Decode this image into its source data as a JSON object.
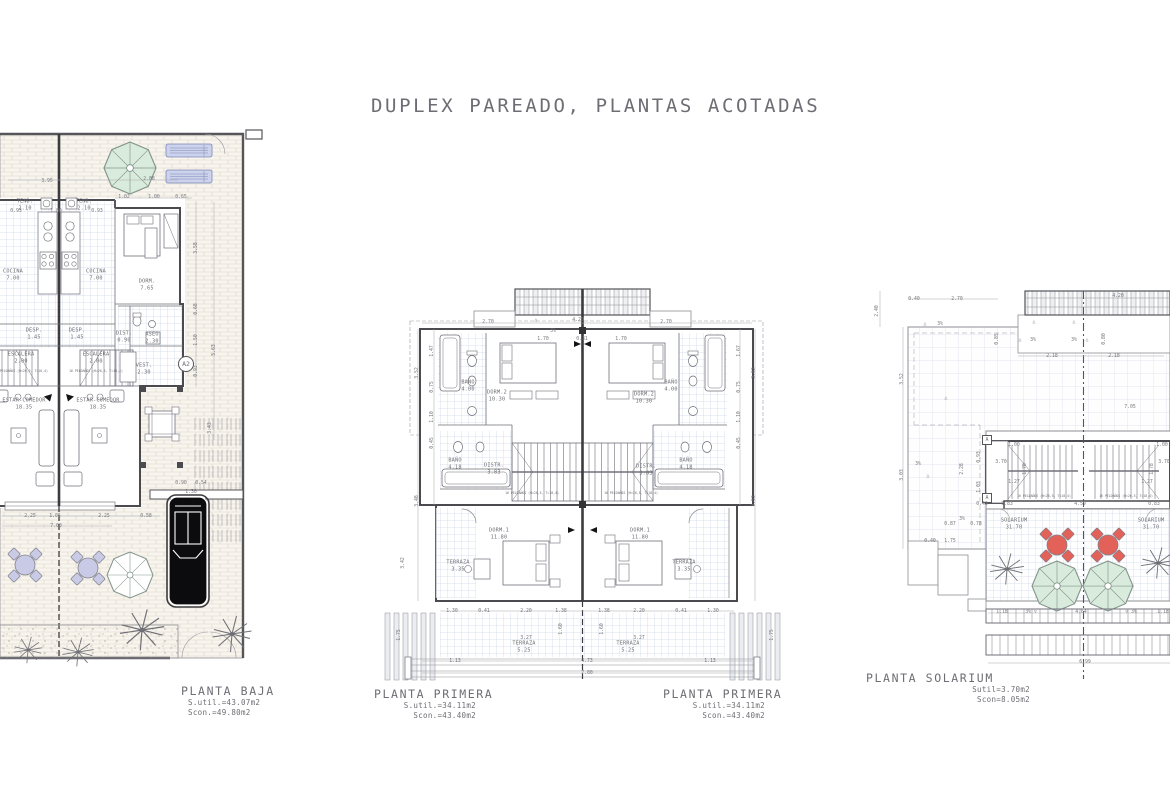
{
  "title": "DUPLEX PAREADO, PLANTAS ACOTADAS",
  "colors": {
    "line": "#8f8f95",
    "wall": "#4a4a4f",
    "text": "#6d6d74",
    "tile": "#bcc3e0",
    "paving": "#ddd5c6",
    "green": "#d8ebdc",
    "blue": "#cdd3ec",
    "purple": "#c9cbe6",
    "red": "#e2625a",
    "car": "#0c0c0e"
  },
  "captions": {
    "baja": {
      "name": "PLANTA BAJA",
      "line1": "S.util.=43.07m2",
      "line2": "Scon.=49.80m2"
    },
    "primera_left": {
      "name": "PLANTA PRIMERA",
      "line1": "S.util.=34.11m2",
      "line2": "Scon.=43.40m2"
    },
    "primera_right": {
      "name": "PLANTA PRIMERA",
      "line1": "S.util.=34.11m2",
      "line2": "Scon.=43.40m2"
    },
    "solarium": {
      "name": "PLANTA SOLARIUM",
      "line1": "Sutil=3.70m2",
      "line2": "Scon=8.05m2"
    }
  },
  "labels": {
    "baja": [
      {
        "t": "TEND.\n2.10",
        "x": 25,
        "y": 77
      },
      {
        "t": "TEND.\n2.10",
        "x": 84,
        "y": 77
      },
      {
        "t": "COCINA\n7.00",
        "x": 13,
        "y": 147
      },
      {
        "t": "COCINA\n7.00",
        "x": 96,
        "y": 147
      },
      {
        "t": "DORM.\n7.65",
        "x": 147,
        "y": 157
      },
      {
        "t": "DESP.\n1.45",
        "x": 34,
        "y": 206
      },
      {
        "t": "DESP.\n1.45",
        "x": 77,
        "y": 206
      },
      {
        "t": "DIST.\n0.90",
        "x": 124,
        "y": 209
      },
      {
        "t": "ASEO\n2.30",
        "x": 152,
        "y": 210
      },
      {
        "t": "ESCALERA\n2.00",
        "x": 21,
        "y": 230
      },
      {
        "t": "ESCALERA\n2.00",
        "x": 96,
        "y": 230
      },
      {
        "t": "16 PELDAÑOS (H=26,5, T=18,4)",
        "x": 21,
        "y": 243,
        "c": "tiny"
      },
      {
        "t": "16 PELDAÑOS (H=26,5, T=18,4)",
        "x": 96,
        "y": 243,
        "c": "tiny"
      },
      {
        "t": "VEST.\n2.30",
        "x": 144,
        "y": 241
      },
      {
        "t": "A2",
        "x": 186,
        "y": 236,
        "c": "marker"
      },
      {
        "t": "ESTAR-COMEDOR\n18.35",
        "x": 24,
        "y": 276
      },
      {
        "t": "ESTAR-COMEDOR\n18.35",
        "x": 98,
        "y": 276
      },
      {
        "t": "3.95",
        "x": 47,
        "y": 54,
        "c": "dim"
      },
      {
        "t": "2.88",
        "x": 149,
        "y": 52,
        "c": "dim"
      },
      {
        "t": "1.02",
        "x": 124,
        "y": 70,
        "c": "dim"
      },
      {
        "t": "1.00",
        "x": 154,
        "y": 70,
        "c": "dim"
      },
      {
        "t": "0.65",
        "x": 181,
        "y": 70,
        "c": "dim"
      },
      {
        "t": "0.93",
        "x": 16,
        "y": 84,
        "c": "dim"
      },
      {
        "t": "1.80",
        "x": 56,
        "y": 84,
        "c": "dim"
      },
      {
        "t": "0.93",
        "x": 97,
        "y": 84,
        "c": "dim"
      },
      {
        "t": "3.58",
        "x": 197,
        "y": 120,
        "c": "dim",
        "r": 90
      },
      {
        "t": "0.68",
        "x": 197,
        "y": 181,
        "c": "dim",
        "r": 90
      },
      {
        "t": "1.50",
        "x": 197,
        "y": 212,
        "c": "dim",
        "r": 90
      },
      {
        "t": "5.63",
        "x": 215,
        "y": 222,
        "c": "dim",
        "r": 90
      },
      {
        "t": "0.93",
        "x": 197,
        "y": 243,
        "c": "dim",
        "r": 90
      },
      {
        "t": "3.43",
        "x": 211,
        "y": 300,
        "c": "dim",
        "r": 90
      },
      {
        "t": "0.90",
        "x": 181,
        "y": 356,
        "c": "dim"
      },
      {
        "t": "0.54",
        "x": 201,
        "y": 356,
        "c": "dim"
      },
      {
        "t": "1.30",
        "x": 191,
        "y": 365,
        "c": "dim"
      },
      {
        "t": "2.25",
        "x": 30,
        "y": 389,
        "c": "dim"
      },
      {
        "t": "1.05",
        "x": 55,
        "y": 389,
        "c": "dim"
      },
      {
        "t": "2.25",
        "x": 104,
        "y": 389,
        "c": "dim"
      },
      {
        "t": "0.58",
        "x": 146,
        "y": 389,
        "c": "dim"
      },
      {
        "t": "7.00",
        "x": 56,
        "y": 399,
        "c": "dim"
      }
    ],
    "primera": [
      {
        "t": "BAÑO\n4.00",
        "x": 90,
        "y": 103
      },
      {
        "t": "DORM.2\n10.30",
        "x": 119,
        "y": 113
      },
      {
        "t": "DISTR.\n3.83",
        "x": 116,
        "y": 186
      },
      {
        "t": "BAÑO\n4.18",
        "x": 77,
        "y": 181
      },
      {
        "t": "DORM.1\n11.80",
        "x": 121,
        "y": 251
      },
      {
        "t": "TERRAZA\n3.35",
        "x": 80,
        "y": 283
      },
      {
        "t": "TERRAZA\n5.25",
        "x": 146,
        "y": 364
      },
      {
        "t": "BAÑO\n4.00",
        "x": 293,
        "y": 103
      },
      {
        "t": "DORM.2\n10.30",
        "x": 266,
        "y": 115
      },
      {
        "t": "DISTR.\n3.83",
        "x": 268,
        "y": 187
      },
      {
        "t": "BAÑO\n4.18",
        "x": 308,
        "y": 181
      },
      {
        "t": "DORM.1\n11.80",
        "x": 262,
        "y": 251
      },
      {
        "t": "TERRAZA\n3.35",
        "x": 306,
        "y": 283
      },
      {
        "t": "TERRAZA\n5.25",
        "x": 250,
        "y": 364
      },
      {
        "t": "16 PELDAÑOS (H=26,5, T=18,4)",
        "x": 154,
        "y": 210,
        "c": "tiny"
      },
      {
        "t": "16 PELDAÑOS (H=26,5, T=18,4)",
        "x": 253,
        "y": 210,
        "c": "tiny"
      },
      {
        "t": "2.70",
        "x": 110,
        "y": 40,
        "c": "dim"
      },
      {
        "t": "△",
        "x": 158,
        "y": 38,
        "c": "dim"
      },
      {
        "t": "4.20",
        "x": 200,
        "y": 38,
        "c": "dim"
      },
      {
        "t": "2.70",
        "x": 288,
        "y": 40,
        "c": "dim"
      },
      {
        "t": "3%",
        "x": 175,
        "y": 49,
        "c": "dim"
      },
      {
        "t": "1.70",
        "x": 165,
        "y": 57,
        "c": "dim"
      },
      {
        "t": "0.31",
        "x": 204,
        "y": 57,
        "c": "dim"
      },
      {
        "t": "1.70",
        "x": 243,
        "y": 57,
        "c": "dim"
      },
      {
        "t": "3.52",
        "x": 40,
        "y": 90,
        "c": "dim",
        "r": 90
      },
      {
        "t": "1.47",
        "x": 55,
        "y": 68,
        "c": "dim",
        "r": 90
      },
      {
        "t": "0.75",
        "x": 55,
        "y": 104,
        "c": "dim",
        "r": 90
      },
      {
        "t": "1.10",
        "x": 55,
        "y": 134,
        "c": "dim",
        "r": 90
      },
      {
        "t": "0.45",
        "x": 55,
        "y": 160,
        "c": "dim",
        "r": 90
      },
      {
        "t": "3.48",
        "x": 40,
        "y": 218,
        "c": "dim",
        "r": 90
      },
      {
        "t": "3.52",
        "x": 377,
        "y": 90,
        "c": "dim",
        "r": 90
      },
      {
        "t": "1.67",
        "x": 362,
        "y": 68,
        "c": "dim",
        "r": 90
      },
      {
        "t": "0.75",
        "x": 362,
        "y": 104,
        "c": "dim",
        "r": 90
      },
      {
        "t": "1.10",
        "x": 362,
        "y": 134,
        "c": "dim",
        "r": 90
      },
      {
        "t": "0.45",
        "x": 362,
        "y": 160,
        "c": "dim",
        "r": 90
      },
      {
        "t": "3.53",
        "x": 377,
        "y": 218,
        "c": "dim",
        "r": 90
      },
      {
        "t": "3.42",
        "x": 26,
        "y": 280,
        "c": "dim",
        "r": 90
      },
      {
        "t": "1.75",
        "x": 22,
        "y": 352,
        "c": "dim",
        "r": 90
      },
      {
        "t": "1.75",
        "x": 395,
        "y": 352,
        "c": "dim",
        "r": 90
      },
      {
        "t": "1.30",
        "x": 74,
        "y": 329,
        "c": "dim"
      },
      {
        "t": "0.41",
        "x": 106,
        "y": 329,
        "c": "dim"
      },
      {
        "t": "2.20",
        "x": 148,
        "y": 329,
        "c": "dim"
      },
      {
        "t": "1.38",
        "x": 183,
        "y": 329,
        "c": "dim"
      },
      {
        "t": "1.38",
        "x": 226,
        "y": 329,
        "c": "dim"
      },
      {
        "t": "2.20",
        "x": 261,
        "y": 329,
        "c": "dim"
      },
      {
        "t": "0.41",
        "x": 303,
        "y": 329,
        "c": "dim"
      },
      {
        "t": "1.30",
        "x": 335,
        "y": 329,
        "c": "dim"
      },
      {
        "t": "1.60",
        "x": 184,
        "y": 346,
        "c": "dim",
        "r": 90
      },
      {
        "t": "1.60",
        "x": 225,
        "y": 346,
        "c": "dim",
        "r": 90
      },
      {
        "t": "3.27",
        "x": 148,
        "y": 356,
        "c": "dim"
      },
      {
        "t": "3.27",
        "x": 261,
        "y": 356,
        "c": "dim"
      },
      {
        "t": "1.13",
        "x": 77,
        "y": 379,
        "c": "dim"
      },
      {
        "t": "4.73",
        "x": 209,
        "y": 379,
        "c": "dim"
      },
      {
        "t": "1.13",
        "x": 332,
        "y": 379,
        "c": "dim"
      },
      {
        "t": "7.00",
        "x": 209,
        "y": 391,
        "c": "dim"
      }
    ],
    "solarium": [
      {
        "t": "SOLARIUM\n31.70",
        "x": 146,
        "y": 241
      },
      {
        "t": "SOLARIUM\n31.70",
        "x": 283,
        "y": 241
      },
      {
        "t": "A",
        "x": 119,
        "y": 157,
        "c": "markersq"
      },
      {
        "t": "A",
        "x": 119,
        "y": 215,
        "c": "markersq"
      },
      {
        "t": "16 PELDAÑOS (H=26,5, T=18,4)",
        "x": 176,
        "y": 213,
        "c": "tiny"
      },
      {
        "t": "16 PELDAÑOS (H=26,5, T=18,4)",
        "x": 258,
        "y": 213,
        "c": "tiny"
      },
      {
        "t": "0.40",
        "x": 46,
        "y": 17,
        "c": "dim"
      },
      {
        "t": "2.70",
        "x": 89,
        "y": 17,
        "c": "dim"
      },
      {
        "t": "4.20",
        "x": 250,
        "y": 14,
        "c": "dim"
      },
      {
        "t": "2.40",
        "x": 10,
        "y": 28,
        "c": "dim",
        "r": 90
      },
      {
        "t": "△",
        "x": 57,
        "y": 42,
        "c": "dim"
      },
      {
        "t": "3%",
        "x": 72,
        "y": 42,
        "c": "dim"
      },
      {
        "t": "△",
        "x": 166,
        "y": 40,
        "c": "dim"
      },
      {
        "t": "△",
        "x": 206,
        "y": 40,
        "c": "dim"
      },
      {
        "t": "0.85",
        "x": 130,
        "y": 56,
        "c": "dim",
        "r": 90
      },
      {
        "t": "△",
        "x": 152,
        "y": 58,
        "c": "dim"
      },
      {
        "t": "3%",
        "x": 165,
        "y": 58,
        "c": "dim"
      },
      {
        "t": "3%",
        "x": 206,
        "y": 58,
        "c": "dim"
      },
      {
        "t": "△",
        "x": 219,
        "y": 58,
        "c": "dim"
      },
      {
        "t": "0.80",
        "x": 237,
        "y": 56,
        "c": "dim",
        "r": 90
      },
      {
        "t": "2.18",
        "x": 184,
        "y": 74,
        "c": "dim"
      },
      {
        "t": "2.18",
        "x": 246,
        "y": 74,
        "c": "dim"
      },
      {
        "t": "3.52",
        "x": 35,
        "y": 96,
        "c": "dim",
        "r": 90
      },
      {
        "t": "7.05",
        "x": 262,
        "y": 125,
        "c": "dim"
      },
      {
        "t": "△",
        "x": 78,
        "y": 116,
        "c": "dim"
      },
      {
        "t": "3%",
        "x": 50,
        "y": 182,
        "c": "dim"
      },
      {
        "t": "△",
        "x": 60,
        "y": 194,
        "c": "dim"
      },
      {
        "t": "3.03",
        "x": 35,
        "y": 192,
        "c": "dim",
        "r": 90
      },
      {
        "t": "1.00",
        "x": 146,
        "y": 163,
        "c": "dim"
      },
      {
        "t": "1.00",
        "x": 294,
        "y": 163,
        "c": "dim"
      },
      {
        "t": "3.70",
        "x": 133,
        "y": 180,
        "c": "dim"
      },
      {
        "t": "3.70",
        "x": 296,
        "y": 180,
        "c": "dim"
      },
      {
        "t": "1.78",
        "x": 158,
        "y": 186,
        "c": "dim",
        "r": 90
      },
      {
        "t": "1.78",
        "x": 285,
        "y": 186,
        "c": "dim",
        "r": 90
      },
      {
        "t": "1.27",
        "x": 146,
        "y": 200,
        "c": "dim"
      },
      {
        "t": "1.27",
        "x": 279,
        "y": 200,
        "c": "dim"
      },
      {
        "t": "0.93",
        "x": 112,
        "y": 174,
        "c": "dim",
        "r": 90
      },
      {
        "t": "2.28",
        "x": 95,
        "y": 186,
        "c": "dim",
        "r": 90
      },
      {
        "t": "1.03",
        "x": 112,
        "y": 204,
        "c": "dim",
        "r": 90
      },
      {
        "t": "0.43",
        "x": 114,
        "y": 222,
        "c": "dim"
      },
      {
        "t": "0.83",
        "x": 139,
        "y": 222,
        "c": "dim"
      },
      {
        "t": "4.59",
        "x": 212,
        "y": 222,
        "c": "dim"
      },
      {
        "t": "0.83",
        "x": 286,
        "y": 222,
        "c": "dim"
      },
      {
        "t": "3%",
        "x": 94,
        "y": 237,
        "c": "dim"
      },
      {
        "t": "0.87",
        "x": 82,
        "y": 242,
        "c": "dim"
      },
      {
        "t": "0.78",
        "x": 108,
        "y": 242,
        "c": "dim"
      },
      {
        "t": "0.40",
        "x": 62,
        "y": 259,
        "c": "dim"
      },
      {
        "t": "1.75",
        "x": 82,
        "y": 259,
        "c": "dim"
      },
      {
        "t": "1.18",
        "x": 134,
        "y": 330,
        "c": "dim"
      },
      {
        "t": "3% ▽",
        "x": 163,
        "y": 330,
        "c": "dim"
      },
      {
        "t": "4.64",
        "x": 213,
        "y": 330,
        "c": "dim"
      },
      {
        "t": "▽ 3%",
        "x": 263,
        "y": 330,
        "c": "dim"
      },
      {
        "t": "1.18",
        "x": 295,
        "y": 330,
        "c": "dim"
      },
      {
        "t": "6.99",
        "x": 217,
        "y": 380,
        "c": "dim"
      }
    ]
  }
}
